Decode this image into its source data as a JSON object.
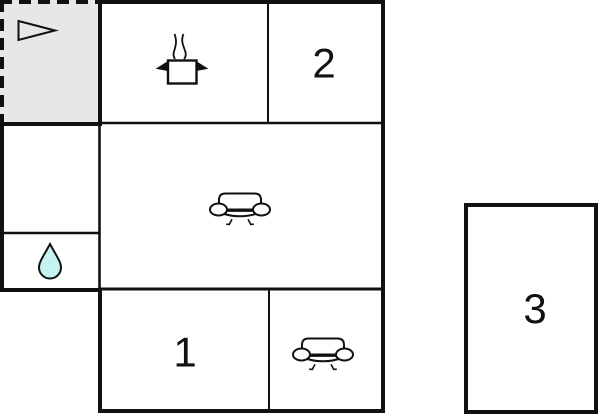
{
  "plan": {
    "title": "apartment-floor-plan",
    "rooms": {
      "room1": {
        "label": "1",
        "type": "bedroom"
      },
      "room2": {
        "label": "2",
        "type": "bedroom"
      },
      "room3": {
        "label": "3",
        "type": "detached-room"
      }
    },
    "icons": {
      "terrace_arrow": "right-pointing-triangle",
      "kitchen_pot": "cooking-pot-with-steam",
      "living_room_sofa": "sofa",
      "lounge_sofa": "sofa",
      "bathroom_drop": "water-drop"
    },
    "colors": {
      "wall": "#111111",
      "terrace_fill": "#e7e7e7",
      "water_drop_fill": "#c5f3f2",
      "icon_fill": "#ffffff",
      "background": "#ffffff"
    }
  }
}
